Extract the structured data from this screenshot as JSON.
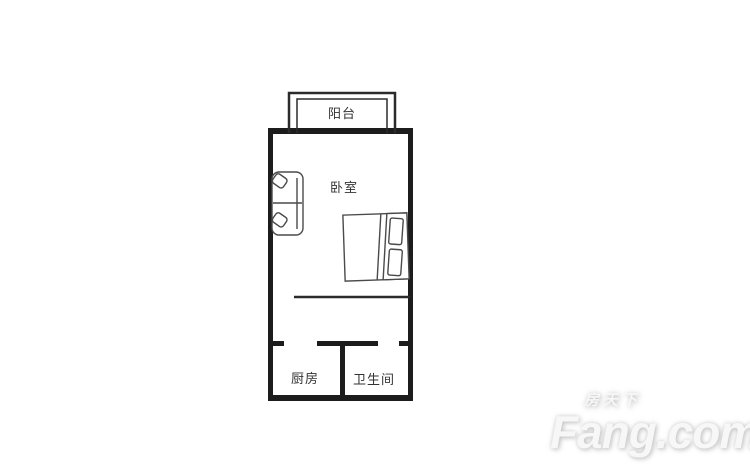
{
  "page": {
    "background_color": "#ffffff"
  },
  "floorplan": {
    "wall_color": "#1c1c1c",
    "thin_wall_color": "#2b2b2b",
    "furniture_color": "#4a4a4a",
    "label_color": "#333333",
    "rooms": {
      "balcony": {
        "label": "阳台"
      },
      "bedroom": {
        "label": "卧室"
      },
      "kitchen": {
        "label": "厨房"
      },
      "bathroom": {
        "label": "卫生间"
      }
    },
    "furniture": [
      {
        "name": "sofa",
        "room": "卧室"
      },
      {
        "name": "double-bed",
        "room": "卧室"
      }
    ]
  },
  "watermark": {
    "brand_cn": "房天下",
    "brand_en": "Fang.com",
    "color": "#f0f0f0"
  }
}
